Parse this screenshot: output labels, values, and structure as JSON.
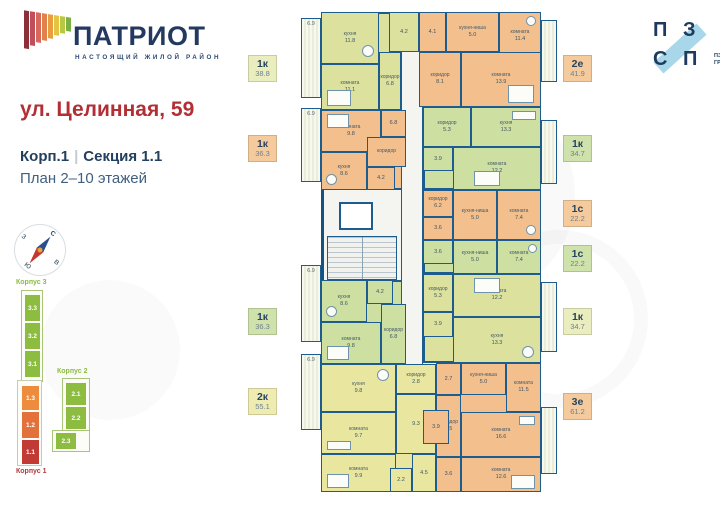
{
  "palette": {
    "wall": "#1d5c8e",
    "orange": "#f2bf8d",
    "green": "#cde0a1",
    "yellow_green": "#dce29e",
    "yellow": "#e9e79f",
    "address_red": "#b22f35",
    "brand_navy": "#24395f",
    "korpus_green": "#8cbc40",
    "korpus_red": "#b5383c",
    "pzsp_blue": "#a7d7e8"
  },
  "header": {
    "brand": {
      "title": "ПАТРИОТ",
      "subtitle": "НАСТОЯЩИЙ ЖИЛОЙ РАЙОН"
    },
    "address": "ул. Целинная, 59",
    "korpus": "Корп.1",
    "divider": "|",
    "section": "Секция 1.1",
    "floors": "План 2–10 этажей"
  },
  "partner": {
    "l1": "П",
    "l2": "З",
    "l3": "С",
    "l4": "П",
    "caption1": "ПЗСП",
    "caption2": "ГРУПП"
  },
  "compass": {
    "n": "С",
    "e": "В",
    "s": "Ю",
    "w": "З"
  },
  "korpuses": {
    "k3": {
      "label": "Корпус 3",
      "c1": "3.3",
      "c2": "3.2",
      "c3": "3.1"
    },
    "k2": {
      "label": "Корпус 2",
      "c1": "2.1",
      "c2": "2.2",
      "c3": "2.3"
    },
    "k1": {
      "label": "Корпус 1",
      "c1": "1.3",
      "c2": "1.2",
      "c3": "1.1"
    }
  },
  "units_left": [
    {
      "type": "1к",
      "area": "38.8"
    },
    {
      "type": "1к",
      "area": "36.3"
    },
    {
      "type": "1к",
      "area": "36.3"
    },
    {
      "type": "2к",
      "area": "55.1"
    }
  ],
  "units_right": [
    {
      "type": "2е",
      "area": "41.9"
    },
    {
      "type": "1к",
      "area": "34.7"
    },
    {
      "type": "1с",
      "area": "22.2"
    },
    {
      "type": "1с",
      "area": "22.2"
    },
    {
      "type": "1к",
      "area": "34.7"
    },
    {
      "type": "3е",
      "area": "61.2"
    }
  ],
  "plan": {
    "balconies": {
      "b1": "6.9",
      "b2": "6.9",
      "b3": "6.9",
      "b4": "6.9"
    },
    "a1": {
      "kitchen": {
        "n": "кухня",
        "a": "11.8"
      },
      "hall": {
        "n": "коридор",
        "a": "6.8"
      },
      "room": {
        "n": "комната",
        "a": "11.1"
      },
      "bath": {
        "a": "4.2"
      }
    },
    "a2": {
      "bath": {
        "a": "4.1"
      },
      "niche": {
        "n": "кухня-ниша",
        "a": "5.0"
      },
      "room1": {
        "n": "комната",
        "a": "11.4"
      },
      "hall": {
        "n": "коридор",
        "a": "8.1"
      },
      "room2": {
        "n": "комната",
        "a": "13.9"
      }
    },
    "a3": {
      "room": {
        "n": "комната",
        "a": "9.8"
      },
      "store": {
        "a": "6.8"
      },
      "hall": {
        "n": "коридор"
      },
      "kitchen": {
        "n": "кухня",
        "a": "8.6"
      },
      "bath": {
        "a": "4.2"
      }
    },
    "a4": {
      "hall": {
        "n": "коридор",
        "a": "5.3"
      },
      "kitchen": {
        "n": "кухня",
        "a": "13.3"
      },
      "bath": {
        "a": "3.9"
      },
      "room": {
        "n": "комната",
        "a": "12.2"
      }
    },
    "a5": {
      "kitchen": {
        "n": "кухня",
        "a": "8.6"
      },
      "bath": {
        "a": "4.2"
      },
      "hall": {
        "n": "коридор",
        "a": "6.8"
      },
      "room": {
        "n": "комната",
        "a": "9.8"
      }
    },
    "a6": {
      "hall": {
        "n": "коридор",
        "a": "6.2"
      },
      "bath": {
        "a": "3.6"
      },
      "niche": {
        "n": "кухня-ниша",
        "a": "5.0"
      },
      "room": {
        "n": "комната",
        "a": "7.4"
      }
    },
    "a7": {
      "bath": {
        "a": "3.6"
      },
      "niche": {
        "n": "кухня-ниша",
        "a": "5.0"
      },
      "room": {
        "n": "комната",
        "a": "7.4"
      }
    },
    "a8": {
      "room": {
        "n": "комната",
        "a": "12.2"
      },
      "hall": {
        "n": "коридор",
        "a": "5.3"
      },
      "bath": {
        "a": "3.9"
      },
      "kitchen": {
        "n": "кухня",
        "a": "13.3"
      }
    },
    "a9": {
      "kitchen": {
        "n": "кухня",
        "a": "9.8"
      },
      "hall1": {
        "n": "коридор",
        "a": "2.8"
      },
      "room1": {
        "n": "комната",
        "a": "9.7"
      },
      "hall2": {
        "a": "9.3"
      },
      "room2": {
        "n": "комната",
        "a": "9.9"
      },
      "bath1": {
        "a": "2.2"
      },
      "bath2": {
        "a": "4.5"
      }
    },
    "a10": {
      "bath1": {
        "a": "2.7"
      },
      "niche": {
        "n": "кухня-ниша",
        "a": "5.0"
      },
      "room1": {
        "n": "комната",
        "a": "11.5"
      },
      "hall": {
        "n": "коридор",
        "a": "8.5"
      },
      "ward": {
        "a": "3.9"
      },
      "room2": {
        "n": "комната",
        "a": "16.6"
      },
      "room3": {
        "n": "комната",
        "a": "12.6"
      },
      "bath2": {
        "a": "3.6"
      }
    }
  }
}
